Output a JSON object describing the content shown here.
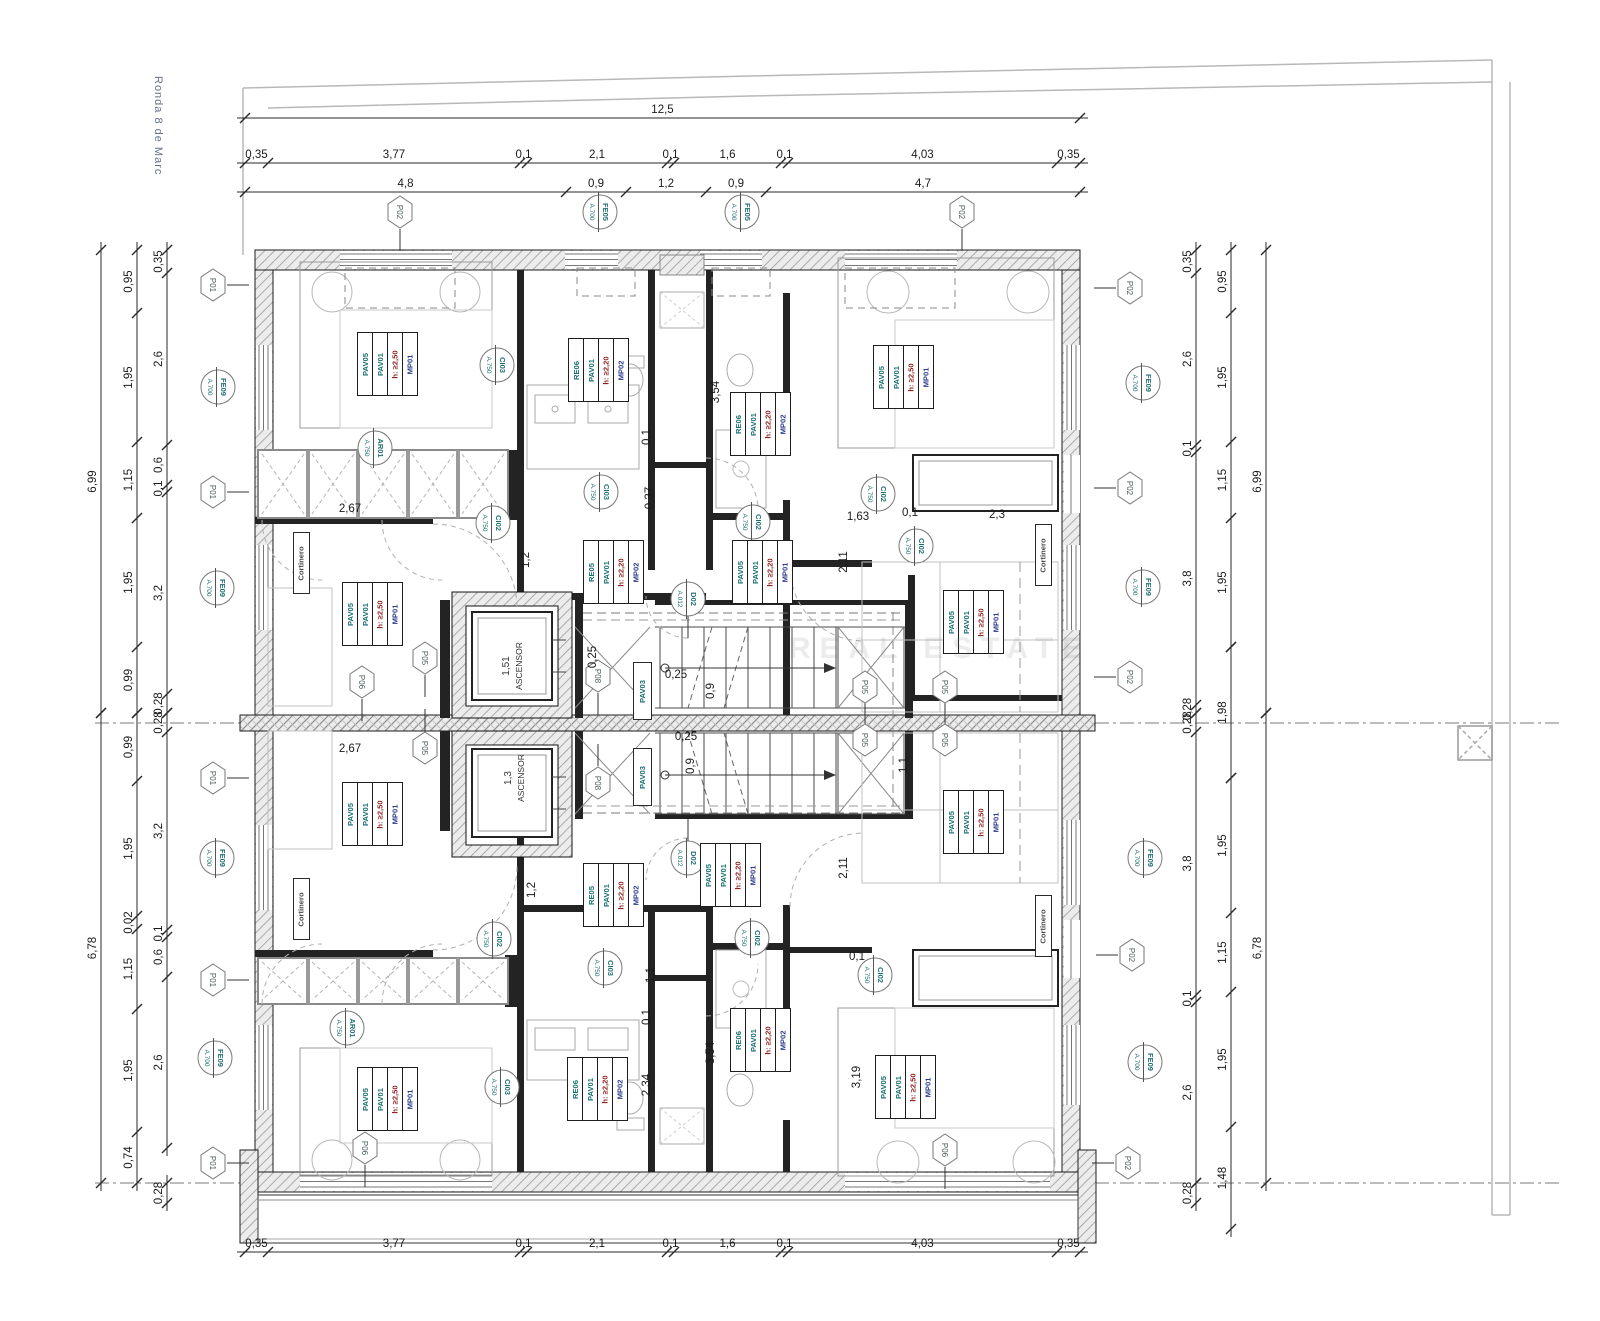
{
  "street_label": "Ronda 8 de Marc",
  "watermark": "REAL ESTATE",
  "colors": {
    "dim_text": "#1a1a1a",
    "marker_text": "#1f6f6f",
    "hex_text": "#4a5a5a",
    "tag_mp": "#2b3a8f",
    "tag_h": "#8f1d1d",
    "tag_pav": "#15706e"
  },
  "elevators": [
    {
      "label": "ASCENSOR",
      "dim": "1,51",
      "x": 516,
      "y": 666
    },
    {
      "label": "ASCENSOR",
      "dim": "1,3",
      "x": 518,
      "y": 778
    }
  ],
  "dimensions": [
    {
      "dir": "h",
      "pos": 118,
      "stops": [
        245,
        1080
      ],
      "labels": [
        "12,5"
      ]
    },
    {
      "dir": "h",
      "pos": 163,
      "stops": [
        245,
        268,
        520,
        527,
        667,
        674,
        781,
        788,
        1057,
        1080
      ],
      "labels": [
        "0,35",
        "3,77",
        "0,1",
        "2,1",
        "0,1",
        "1,6",
        "0,1",
        "4,03",
        "0,35"
      ]
    },
    {
      "dir": "h",
      "pos": 192,
      "stops": [
        245,
        566,
        626,
        706,
        766,
        1080
      ],
      "labels": [
        "4,8",
        "0,9",
        "1,2",
        "0,9",
        "4,7"
      ]
    },
    {
      "dir": "h",
      "pos": 1252,
      "stops": [
        245,
        268,
        520,
        527,
        667,
        674,
        781,
        788,
        1057,
        1080
      ],
      "labels": [
        "0,35",
        "3,77",
        "0,1",
        "2,1",
        "0,1",
        "1,6",
        "0,1",
        "4,03",
        "0,35"
      ]
    },
    {
      "dir": "v",
      "pos": 101,
      "stops": [
        250,
        713
      ],
      "labels": [
        "6,99"
      ]
    },
    {
      "dir": "v",
      "pos": 101,
      "stops": [
        713,
        1183
      ],
      "labels": [
        "6,78"
      ]
    },
    {
      "dir": "v",
      "pos": 137,
      "stops": [
        250,
        313,
        442,
        518,
        647,
        713
      ],
      "labels": [
        "0,95",
        "1,95",
        "1,15",
        "1,95",
        "0,99"
      ]
    },
    {
      "dir": "v",
      "pos": 137,
      "stops": [
        713,
        781,
        916,
        929,
        1009,
        1132,
        1183
      ],
      "labels": [
        "0,99",
        "1,95",
        "0,02",
        "1,15",
        "1,95",
        "0,74"
      ]
    },
    {
      "dir": "v",
      "pos": 167,
      "stops": [
        250,
        273,
        445,
        485,
        492,
        694,
        713
      ],
      "labels": [
        "0,35",
        "2,6",
        "0,6",
        "0,1",
        "3,2",
        "0,28"
      ]
    },
    {
      "dir": "v",
      "pos": 167,
      "stops": [
        713,
        732,
        930,
        937,
        977,
        1148
      ],
      "labels": [
        "0,28",
        "3,2",
        "0,1",
        "0,6",
        "2,6"
      ]
    },
    {
      "dir": "v",
      "pos": 167,
      "stops": [
        1183,
        1203
      ],
      "labels": [
        "0,28"
      ]
    },
    {
      "dir": "v",
      "pos": 1196,
      "stops": [
        250,
        273,
        445,
        452,
        705,
        713
      ],
      "labels": [
        "0,35",
        "2,6",
        "0,1",
        "3,8",
        "0,28"
      ]
    },
    {
      "dir": "v",
      "pos": 1196,
      "stops": [
        713,
        732,
        995,
        1002,
        1183
      ],
      "labels": [
        "0,28",
        "3,8",
        "0,1",
        "2,6"
      ]
    },
    {
      "dir": "v",
      "pos": 1196,
      "stops": [
        1183,
        1203
      ],
      "labels": [
        "0,28"
      ]
    },
    {
      "dir": "v",
      "pos": 1231,
      "stops": [
        250,
        313,
        442,
        518,
        647
      ],
      "labels": [
        "0,95",
        "1,95",
        "1,15",
        "1,95"
      ]
    },
    {
      "dir": "v",
      "pos": 1231,
      "stops": [
        647,
        778
      ],
      "labels": [
        "1,98"
      ]
    },
    {
      "dir": "v",
      "pos": 1231,
      "stops": [
        778,
        913,
        992,
        1127,
        1229
      ],
      "labels": [
        "1,95",
        "1,15",
        "1,95",
        "1,48"
      ]
    },
    {
      "dir": "v",
      "pos": 1266,
      "stops": [
        250,
        713
      ],
      "labels": [
        "6,99"
      ]
    },
    {
      "dir": "v",
      "pos": 1266,
      "stops": [
        713,
        1183
      ],
      "labels": [
        "6,78"
      ]
    }
  ],
  "free_labels": [
    [
      "2,67",
      350,
      512,
      0
    ],
    [
      "2,67",
      350,
      752,
      0
    ],
    [
      "2,34",
      616,
      357,
      -90
    ],
    [
      "2,34",
      650,
      1085,
      -90
    ],
    [
      "3,54",
      719,
      392,
      -90
    ],
    [
      "3,54",
      714,
      1053,
      -90
    ],
    [
      "0,1",
      650,
      437,
      -90
    ],
    [
      "0,37",
      653,
      498,
      -90
    ],
    [
      "1,1",
      654,
      975,
      -90
    ],
    [
      "0,1",
      650,
      1017,
      -90
    ],
    [
      "1,2",
      529,
      560,
      -90
    ],
    [
      "1,2",
      535,
      890,
      -90
    ],
    [
      "1,63",
      858,
      520,
      0
    ],
    [
      "0,1",
      910,
      516,
      0
    ],
    [
      "2,3",
      997,
      518,
      0
    ],
    [
      "0,1",
      857,
      960,
      0
    ],
    [
      "3,19",
      860,
      1077,
      -90
    ],
    [
      "2,11",
      847,
      562,
      -90
    ],
    [
      "2,11",
      847,
      868,
      -90
    ],
    [
      "0,25",
      596,
      657,
      -90
    ],
    [
      "0,25",
      676,
      678,
      0
    ],
    [
      "0,9",
      714,
      691,
      -90
    ],
    [
      "0,25",
      686,
      740,
      0
    ],
    [
      "0,9",
      694,
      766,
      -90
    ],
    [
      "1,1",
      907,
      765,
      -90
    ]
  ],
  "hex_markers": [
    [
      "P01",
      213,
      285,
      "r"
    ],
    [
      "P01",
      213,
      492,
      "r"
    ],
    [
      "P01",
      213,
      778,
      "r"
    ],
    [
      "P01",
      213,
      980,
      "r"
    ],
    [
      "P01",
      213,
      1163,
      "r"
    ],
    [
      "P02",
      400,
      212,
      "d"
    ],
    [
      "P02",
      962,
      212,
      "d"
    ],
    [
      "P02",
      1130,
      288,
      "l"
    ],
    [
      "P02",
      1130,
      488,
      "l"
    ],
    [
      "P02",
      1130,
      677,
      "l"
    ],
    [
      "P02",
      1132,
      955,
      "l"
    ],
    [
      "P02",
      1128,
      1163,
      "l"
    ],
    [
      "P05",
      425,
      658,
      "d"
    ],
    [
      "P05",
      425,
      748,
      "u"
    ],
    [
      "P05",
      865,
      687,
      "d"
    ],
    [
      "P05",
      945,
      687,
      "d"
    ],
    [
      "P05",
      865,
      740,
      "u"
    ],
    [
      "P05",
      945,
      740,
      "u"
    ],
    [
      "P06",
      362,
      682,
      "d"
    ],
    [
      "P06",
      365,
      1148,
      "d"
    ],
    [
      "P06",
      945,
      1150,
      "d"
    ],
    [
      "P08",
      598,
      676,
      "d"
    ],
    [
      "P08",
      598,
      783,
      "u"
    ]
  ],
  "circle_markers": [
    [
      "FE05",
      "A.700",
      600,
      212,
      ""
    ],
    [
      "FE05",
      "A.700",
      742,
      212,
      ""
    ],
    [
      "FE09",
      "A.700",
      218,
      387,
      ""
    ],
    [
      "FE09",
      "A.700",
      217,
      588,
      ""
    ],
    [
      "FE09",
      "A.700",
      217,
      858,
      ""
    ],
    [
      "FE09",
      "A.700",
      215,
      1058,
      ""
    ],
    [
      "FE09",
      "A.700",
      1143,
      383,
      ""
    ],
    [
      "FE09",
      "A.700",
      1143,
      587,
      ""
    ],
    [
      "FE09",
      "A.700",
      1145,
      858,
      ""
    ],
    [
      "FE09",
      "A.700",
      1145,
      1062,
      ""
    ],
    [
      "CI03",
      "A.750",
      497,
      365,
      ""
    ],
    [
      "CI03",
      "A.750",
      601,
      492,
      ""
    ],
    [
      "CI03",
      "A.750",
      605,
      968,
      ""
    ],
    [
      "CI03",
      "A.750",
      502,
      1087,
      ""
    ],
    [
      "CI02",
      "A.750",
      493,
      523,
      ""
    ],
    [
      "CI02",
      "A.750",
      753,
      522,
      ""
    ],
    [
      "CI02",
      "A.750",
      878,
      494,
      ""
    ],
    [
      "CI02",
      "A.750",
      916,
      546,
      ""
    ],
    [
      "CI02",
      "A.750",
      494,
      939,
      ""
    ],
    [
      "CI02",
      "A.750",
      752,
      938,
      ""
    ],
    [
      "CI02",
      "A.750",
      875,
      975,
      ""
    ],
    [
      "AR01",
      "A.750",
      375,
      448,
      ""
    ],
    [
      "AR01",
      "A.750",
      347,
      1028,
      ""
    ],
    [
      "D02",
      "A.012",
      688,
      599,
      "d"
    ],
    [
      "D02",
      "A.012",
      688,
      858,
      "u"
    ]
  ],
  "tag_types": {
    "bed50": [
      "MP01",
      "h: ≥2,50",
      "PAV01",
      "PAV05"
    ],
    "bed20": [
      "MP01",
      "h: ≥2,20",
      "PAV01",
      "PAV05"
    ],
    "bath": [
      "MP02",
      "h: ≥2,20",
      "PAV01",
      "RE06"
    ],
    "hall": [
      "MP02",
      "h: ≥2,20",
      "PAV01",
      "RE05"
    ]
  },
  "tag_cell_colors": [
    "blue",
    "red",
    "teal",
    "teal"
  ],
  "room_tags": [
    {
      "x": 357,
      "y": 332,
      "type": "bed50"
    },
    {
      "x": 873,
      "y": 345,
      "type": "bed50"
    },
    {
      "x": 342,
      "y": 582,
      "type": "bed50"
    },
    {
      "x": 943,
      "y": 590,
      "type": "bed50"
    },
    {
      "x": 342,
      "y": 782,
      "type": "bed50"
    },
    {
      "x": 943,
      "y": 790,
      "type": "bed50"
    },
    {
      "x": 357,
      "y": 1067,
      "type": "bed50"
    },
    {
      "x": 875,
      "y": 1055,
      "type": "bed50"
    },
    {
      "x": 732,
      "y": 540,
      "type": "bed20"
    },
    {
      "x": 700,
      "y": 843,
      "type": "bed20"
    },
    {
      "x": 568,
      "y": 338,
      "type": "bath"
    },
    {
      "x": 730,
      "y": 392,
      "type": "bath"
    },
    {
      "x": 567,
      "y": 1057,
      "type": "bath"
    },
    {
      "x": 730,
      "y": 1008,
      "type": "bath"
    },
    {
      "x": 583,
      "y": 540,
      "type": "hall"
    },
    {
      "x": 583,
      "y": 863,
      "type": "hall"
    }
  ],
  "small_tags": [
    {
      "t": "PAV03",
      "x": 633,
      "y": 662,
      "c": "teal",
      "w": 17,
      "h": 56
    },
    {
      "t": "PAV03",
      "x": 633,
      "y": 748,
      "c": "teal",
      "w": 17,
      "h": 56
    },
    {
      "t": "Cortinero",
      "x": 293,
      "y": 532,
      "c": "gray",
      "w": 15,
      "h": 60
    },
    {
      "t": "Cortinero",
      "x": 293,
      "y": 878,
      "c": "gray",
      "w": 15,
      "h": 60
    },
    {
      "t": "Cortinero",
      "x": 1035,
      "y": 524,
      "c": "gray",
      "w": 15,
      "h": 60
    },
    {
      "t": "Cortinero",
      "x": 1035,
      "y": 895,
      "c": "gray",
      "w": 15,
      "h": 60
    }
  ]
}
